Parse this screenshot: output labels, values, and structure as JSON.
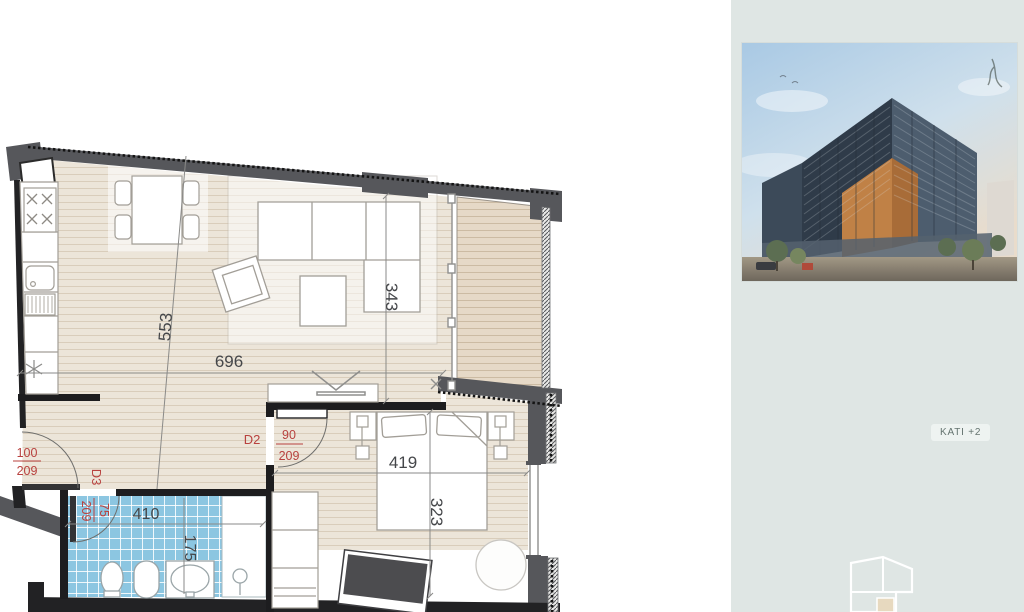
{
  "plan": {
    "dims": {
      "living_diagonal": "553",
      "living_width": "696",
      "balcony_depth": "343",
      "bedroom_width": "419",
      "bedroom_depth": "323",
      "bathroom_width": "410",
      "bathroom_depth": "175"
    },
    "doors": {
      "entrance": {
        "width": "100",
        "height": "209"
      },
      "d3": {
        "label": "D3",
        "width": "75",
        "height": "209"
      },
      "d2": {
        "label": "D2",
        "width": "90",
        "height": "209"
      }
    },
    "icons": {
      "gas_burner": "asterisk-symbol",
      "stove_burners": "x-cross-symbols",
      "tv": "chevron-symbol",
      "shower_head": "circle-with-stem"
    }
  },
  "sidebar": {
    "floor_badge": "KATI +2"
  },
  "colors": {
    "wall_exterior": "#56575b",
    "wall_interior": "#1d1d1f",
    "floor_beige": "#ece5d9",
    "balcony_deck": "#e6d9c7",
    "tile_blue": "#8cc6e1",
    "label_red": "#b8413e",
    "sidebar_bg": "#dfe6e4"
  }
}
